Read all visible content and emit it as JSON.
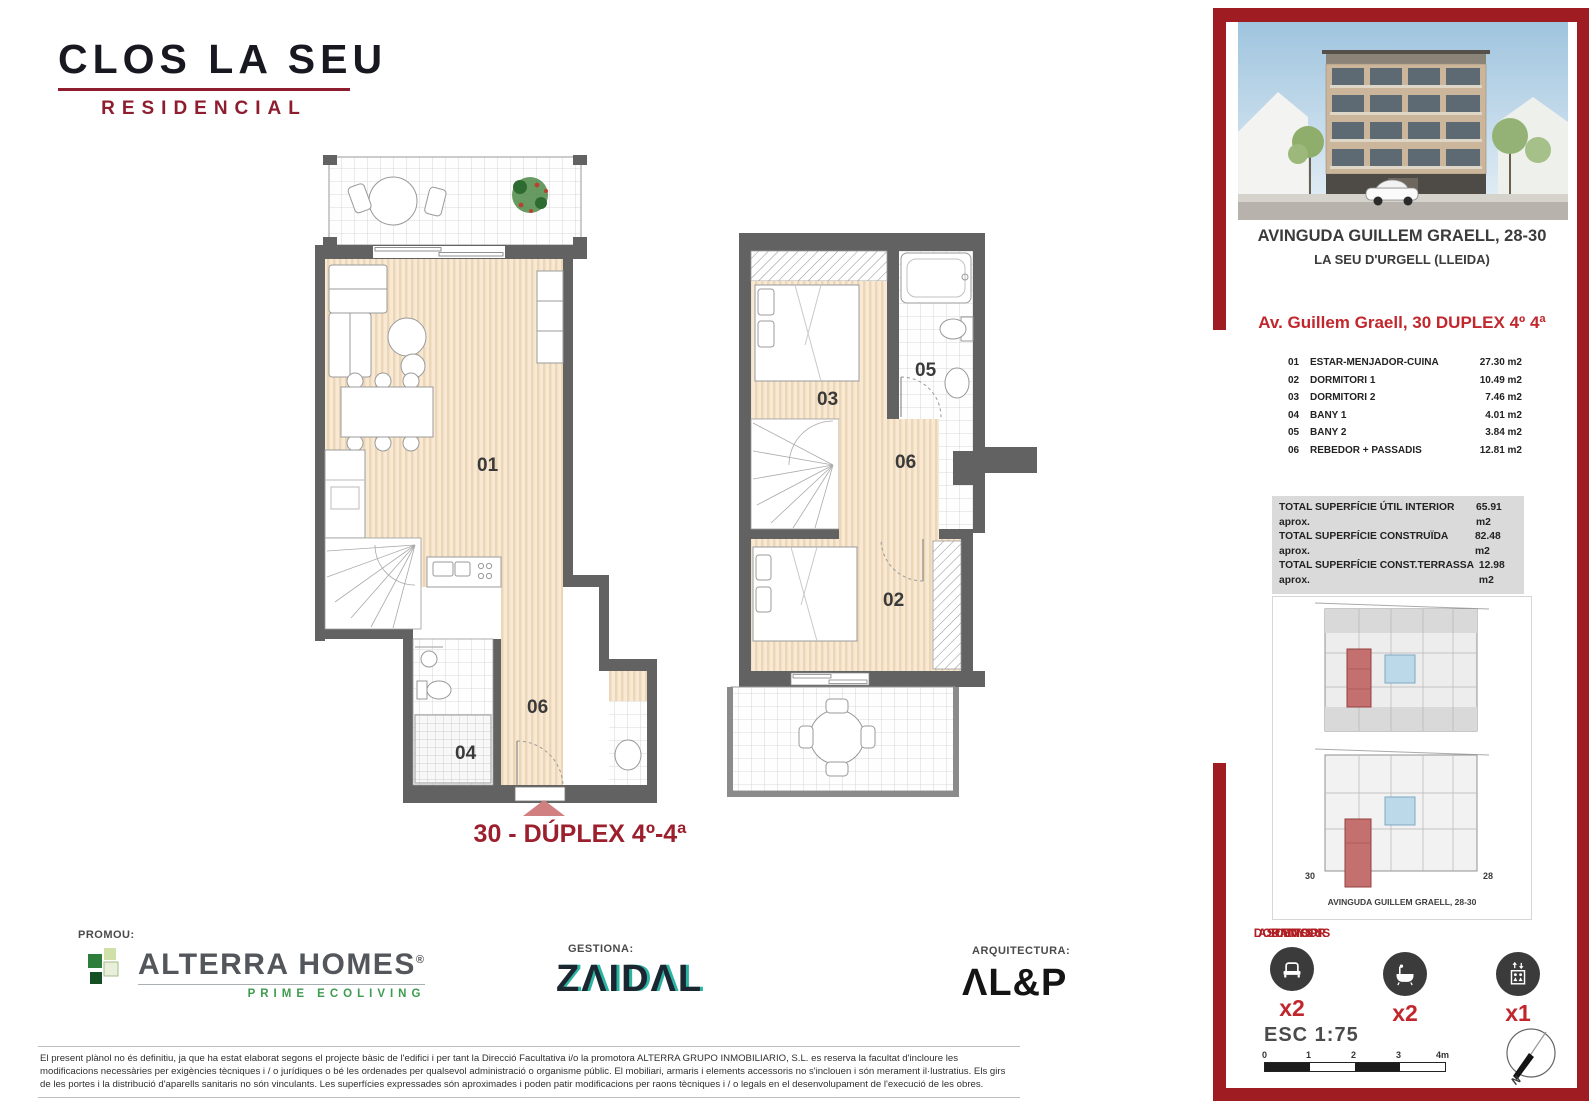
{
  "brand": {
    "name": "CLOS LA SEU",
    "tagline": "RESIDENCIAL"
  },
  "plans": {
    "caption": "30 - DÚPLEX 4º-4ª",
    "lower": {
      "living": "01",
      "hall": "06",
      "bath": "04"
    },
    "upper": {
      "bed2": "03",
      "bath": "05",
      "hall": "06",
      "bed1": "02"
    }
  },
  "footer": {
    "promoter_label": "PROMOU:",
    "manager_label": "GESTIONA:",
    "architect_label": "ARQUITECTURA:",
    "promoter_name": "ALTERRA HOMES",
    "promoter_reg": "®",
    "promoter_tagline": "PRIME ECOLIVING",
    "manager_name": "ZΛIDΛL",
    "architect_name": "ΛL&P",
    "disclaimer": "El present plànol no és definitiu, ja que ha estat elaborat segons el projecte bàsic de l'edifici i per tant la Direcció Facultativa i/o la promotora  ALTERRA GRUPO INMOBILIARIO, S.L. es reserva la facultat d'incloure les modificacions necessàries per exigències tècniques i / o jurídiques o bé les ordenades per qualsevol administració o organisme públic. El mobiliari, armaris i elements accessoris no s'inclouen i són merament il·lustratius. Els girs de les portes i la distribució d'aparells sanitaris no són vinculants. Les superfícies expressades són aproximades i poden patir modificacions per raons tècniques  i / o legals en el desenvolupament de l'execució de les obres."
  },
  "sidebar": {
    "address_line1": "AVINGUDA GUILLEM GRAELL, 28-30",
    "address_line2": "LA SEU D'URGELL (LLEIDA)",
    "unit_title": "Av. Guillem Graell, 30 DUPLEX  4º 4ª",
    "rooms": [
      {
        "num": "01",
        "name": "ESTAR-MENJADOR-CUINA",
        "area": "27.30 m2"
      },
      {
        "num": "02",
        "name": "DORMITORI 1",
        "area": "10.49 m2"
      },
      {
        "num": "03",
        "name": "DORMITORI 2",
        "area": "7.46 m2"
      },
      {
        "num": "04",
        "name": "BANY 1",
        "area": "4.01 m2"
      },
      {
        "num": "05",
        "name": "BANY 2",
        "area": "3.84 m2"
      },
      {
        "num": "06",
        "name": "REBEDOR + PASSADIS",
        "area": "12.81 m2"
      }
    ],
    "totals": [
      {
        "label": "TOTAL SUPERFÍCIE ÚTIL INTERIOR aprox.",
        "value": "65.91 m2"
      },
      {
        "label": "TOTAL SUPERFÍCIE CONSTRUÏDA aprox.",
        "value": "82.48 m2"
      },
      {
        "label": "TOTAL SUPERFÍCIE CONST.TERRASSA aprox.",
        "value": "12.98 m2"
      }
    ],
    "keyplan": {
      "left_num": "30",
      "right_num": "28",
      "caption": "AVINGUDA GUILLEM GRAELL, 28-30"
    },
    "features": [
      {
        "label": "DORMITORIS",
        "count": "x2",
        "icon": "bed-icon"
      },
      {
        "label": "BANYS",
        "count": "x2",
        "icon": "bathtub-icon"
      },
      {
        "label": "ASCENSOR",
        "count": "x1",
        "icon": "elevator-icon"
      }
    ],
    "scale": {
      "label": "ESC 1:75",
      "ticks": [
        "0",
        "1",
        "2",
        "3",
        "4m"
      ]
    },
    "compass_n": "N"
  },
  "colors": {
    "frame_red": "#9e1c22",
    "accent_red": "#c1272d",
    "maroon": "#8e1d2f",
    "wall_gray": "#626262",
    "wood": "#f7e9d4",
    "patio_blue": "#bcd9ea",
    "unit_red": "#c4706f",
    "eco_green": "#3f9b4f",
    "teal": "#2bb3a3"
  }
}
